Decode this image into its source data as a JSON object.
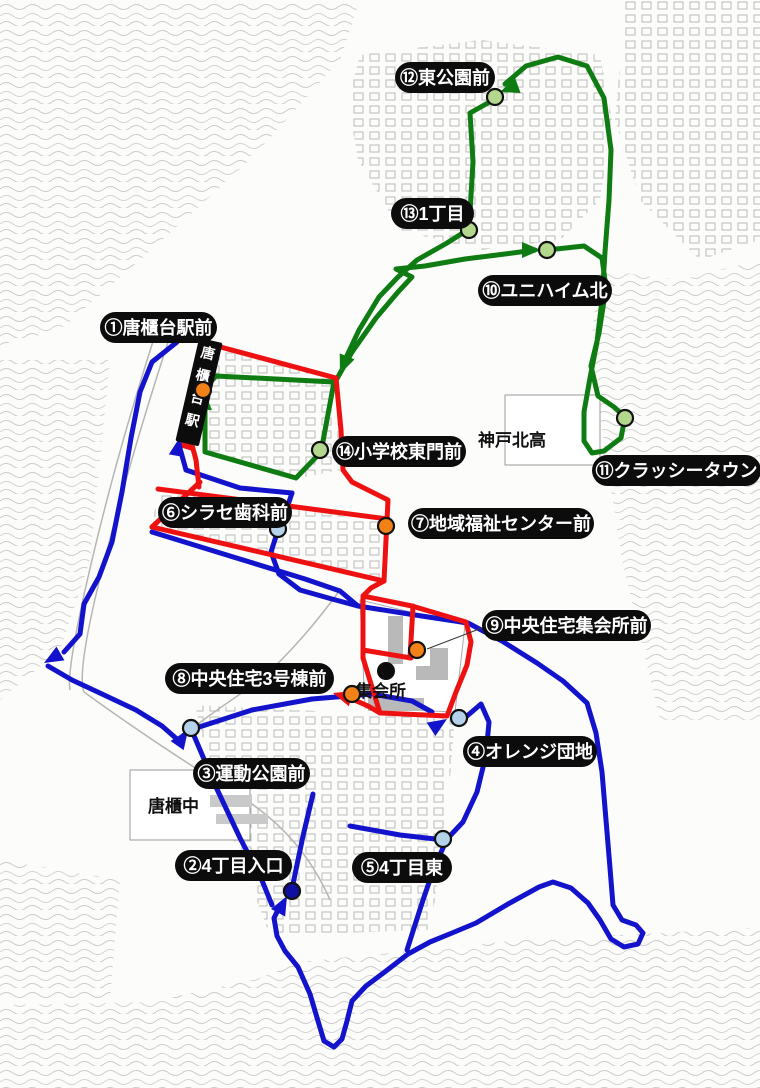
{
  "title": "community bus route map",
  "routes": {
    "colors": {
      "green": "#0e7c12",
      "red": "#ee1111",
      "blue": "#1313cc"
    },
    "paths": {
      "blue": [
        [
          [
            186,
            470
          ],
          [
            181,
            452
          ]
        ],
        [
          [
            177,
            342
          ],
          [
            152,
            362
          ],
          [
            140,
            392
          ],
          [
            131,
            438
          ],
          [
            122,
            492
          ],
          [
            112,
            542
          ],
          [
            99,
            577
          ],
          [
            84,
            604
          ],
          [
            80,
            634
          ],
          [
            64,
            652
          ]
        ],
        [
          [
            48,
            666
          ],
          [
            72,
            680
          ],
          [
            102,
            694
          ],
          [
            136,
            710
          ],
          [
            162,
            726
          ],
          [
            178,
            740
          ],
          [
            184,
            735
          ]
        ],
        [
          [
            186,
            470
          ],
          [
            240,
            488
          ],
          [
            292,
            493
          ]
        ],
        [
          [
            292,
            493
          ],
          [
            283,
            520
          ],
          [
            278,
            530
          ],
          [
            271,
            552
          ],
          [
            279,
            574
          ],
          [
            300,
            590
          ],
          [
            332,
            599
          ],
          [
            358,
            606
          ]
        ],
        [
          [
            152,
            532
          ],
          [
            230,
            556
          ],
          [
            305,
            579
          ],
          [
            340,
            591
          ],
          [
            358,
            606
          ]
        ],
        [
          [
            358,
            606
          ],
          [
            415,
            615
          ],
          [
            468,
            623
          ],
          [
            502,
            641
          ],
          [
            537,
            663
          ],
          [
            563,
            681
          ],
          [
            587,
            703
          ],
          [
            596,
            733
          ],
          [
            602,
            772
          ],
          [
            606,
            820
          ],
          [
            610,
            868
          ],
          [
            613,
            905
          ],
          [
            622,
            920
          ],
          [
            636,
            925
          ],
          [
            643,
            933
          ],
          [
            638,
            944
          ],
          [
            624,
            947
          ],
          [
            611,
            939
          ],
          [
            600,
            920
          ],
          [
            588,
            903
          ],
          [
            571,
            888
          ],
          [
            553,
            882
          ],
          [
            539,
            887
          ],
          [
            508,
            904
          ],
          [
            476,
            923
          ],
          [
            452,
            933
          ],
          [
            430,
            942
          ],
          [
            408,
            954
          ],
          [
            386,
            971
          ],
          [
            366,
            986
          ],
          [
            352,
            1001
          ],
          [
            347,
            1021
          ],
          [
            342,
            1039
          ],
          [
            334,
            1047
          ],
          [
            324,
            1041
          ],
          [
            318,
            1021
          ],
          [
            310,
            994
          ],
          [
            298,
            967
          ],
          [
            285,
            951
          ],
          [
            277,
            936
          ],
          [
            274,
            918
          ],
          [
            280,
            906
          ]
        ],
        [
          [
            193,
            729
          ],
          [
            252,
            710
          ],
          [
            312,
            699
          ],
          [
            372,
            694
          ],
          [
            412,
            701
          ],
          [
            432,
            712
          ]
        ],
        [
          [
            192,
            731
          ],
          [
            215,
            785
          ],
          [
            240,
            838
          ],
          [
            261,
            878
          ],
          [
            272,
            905
          ]
        ],
        [
          [
            460,
            722
          ],
          [
            481,
            704
          ],
          [
            489,
            722
          ],
          [
            486,
            755
          ],
          [
            477,
            792
          ],
          [
            463,
            822
          ],
          [
            447,
            839
          ],
          [
            434,
            868
          ],
          [
            423,
            900
          ],
          [
            414,
            928
          ],
          [
            407,
            950
          ]
        ],
        [
          [
            350,
            826
          ],
          [
            400,
            835
          ],
          [
            444,
            840
          ]
        ],
        [
          [
            293,
            884
          ],
          [
            303,
            836
          ],
          [
            313,
            794
          ]
        ]
      ],
      "green": [
        [
          [
            205,
            405
          ],
          [
            205,
            396
          ]
        ],
        [
          [
            205,
            395
          ],
          [
            205,
            452
          ],
          [
            296,
            478
          ],
          [
            321,
            452
          ],
          [
            334,
            382
          ],
          [
            216,
            376
          ],
          [
            206,
            387
          ],
          [
            205,
            395
          ]
        ],
        [
          [
            334,
            384
          ],
          [
            352,
            352
          ],
          [
            376,
            318
          ],
          [
            398,
            292
          ],
          [
            412,
            277
          ],
          [
            396,
            269
          ],
          [
            425,
            266
          ],
          [
            465,
            259
          ],
          [
            505,
            254
          ],
          [
            535,
            250
          ]
        ],
        [
          [
            547,
            250
          ],
          [
            584,
            246
          ],
          [
            602,
            258
          ],
          [
            606,
            288
          ],
          [
            599,
            333
          ],
          [
            591,
            366
          ],
          [
            598,
            396
          ],
          [
            614,
            407
          ],
          [
            625,
            417
          ],
          [
            621,
            438
          ],
          [
            604,
            451
          ],
          [
            592,
            453
          ],
          [
            584,
            441
          ],
          [
            584,
            412
          ],
          [
            590,
            378
          ],
          [
            597,
            342
          ],
          [
            602,
            300
          ],
          [
            605,
            252
          ],
          [
            609,
            200
          ],
          [
            611,
            150
          ],
          [
            604,
            98
          ],
          [
            587,
            66
          ],
          [
            558,
            57
          ],
          [
            526,
            66
          ],
          [
            505,
            84
          ]
        ],
        [
          [
            495,
            99
          ],
          [
            470,
            113
          ],
          [
            473,
            162
          ],
          [
            469,
            229
          ],
          [
            447,
            243
          ],
          [
            417,
            260
          ],
          [
            398,
            277
          ],
          [
            379,
            297
          ],
          [
            359,
            330
          ],
          [
            344,
            362
          ]
        ]
      ],
      "red": [
        [
          [
            199,
            487
          ],
          [
            196,
            460
          ],
          [
            192,
            445
          ]
        ],
        [
          [
            213,
            345
          ],
          [
            203,
            382
          ],
          [
            196,
            418
          ]
        ],
        [
          [
            213,
            345
          ],
          [
            336,
            378
          ],
          [
            341,
            430
          ],
          [
            343,
            470
          ],
          [
            352,
            482
          ],
          [
            388,
            500
          ],
          [
            386,
            540
          ],
          [
            384,
            581
          ]
        ],
        [
          [
            158,
            489
          ],
          [
            388,
            519
          ]
        ],
        [
          [
            200,
            482
          ],
          [
            152,
            527
          ]
        ],
        [
          [
            152,
            527
          ],
          [
            384,
            581
          ]
        ],
        [
          [
            384,
            581
          ],
          [
            371,
            588
          ],
          [
            363,
            596
          ],
          [
            363,
            658
          ]
        ],
        [
          [
            363,
            596
          ],
          [
            412,
            606
          ],
          [
            466,
            622
          ],
          [
            471,
            642
          ],
          [
            467,
            665
          ],
          [
            456,
            692
          ],
          [
            447,
            716
          ],
          [
            380,
            713
          ],
          [
            363,
            658
          ]
        ],
        [
          [
            363,
            650
          ],
          [
            411,
            658
          ]
        ],
        [
          [
            413,
            606
          ],
          [
            410,
            658
          ]
        ],
        [
          [
            380,
            713
          ],
          [
            368,
            706
          ],
          [
            352,
            699
          ],
          [
            340,
            695
          ]
        ]
      ]
    }
  },
  "arrows": [
    {
      "c": "green",
      "x": 204,
      "y": 391,
      "a": -90
    },
    {
      "c": "green",
      "x": 340,
      "y": 374,
      "a": 112
    },
    {
      "c": "green",
      "x": 541,
      "y": 250,
      "a": 0
    },
    {
      "c": "green",
      "x": 500,
      "y": 92,
      "a": 160
    },
    {
      "c": "red",
      "x": 189,
      "y": 430,
      "a": -73
    },
    {
      "c": "red",
      "x": 333,
      "y": 693,
      "a": 197
    },
    {
      "c": "blue",
      "x": 180,
      "y": 437,
      "a": -80
    },
    {
      "c": "blue",
      "x": 44,
      "y": 663,
      "a": 150
    },
    {
      "c": "blue",
      "x": 188,
      "y": 730,
      "a": -55
    },
    {
      "c": "blue",
      "x": 447,
      "y": 719,
      "a": -33
    },
    {
      "c": "blue",
      "x": 287,
      "y": 896,
      "a": -62
    }
  ],
  "marker_colors": {
    "orange": "#f28118",
    "lightgreen": "#b2d78d",
    "lightblue": "#b4d2ea",
    "darkblue": "#0f0fa0"
  },
  "stops": [
    {
      "label": "①唐櫃台駅前",
      "marker": "orange",
      "mx": 203,
      "my": 390,
      "lx": 100,
      "ly": 312
    },
    {
      "label": "②4丁目入口",
      "marker": "darkblue",
      "mx": 292,
      "my": 891,
      "lx": 175,
      "ly": 850
    },
    {
      "label": "③運動公園前",
      "marker": "lightblue",
      "mx": 191,
      "my": 728,
      "lx": 193,
      "ly": 758
    },
    {
      "label": "④オレンジ団地",
      "marker": "lightblue",
      "mx": 459,
      "my": 718,
      "lx": 463,
      "ly": 736
    },
    {
      "label": "⑤4丁目東",
      "marker": "lightblue",
      "mx": 443,
      "my": 839,
      "lx": 352,
      "ly": 852
    },
    {
      "label": "⑥シラセ歯科前",
      "marker": "lightblue",
      "mx": 278,
      "my": 529,
      "lx": 158,
      "ly": 497
    },
    {
      "label": "⑦地域福祉センター前",
      "marker": "orange",
      "mx": 386,
      "my": 526,
      "lx": 408,
      "ly": 508
    },
    {
      "label": "⑧中央住宅3号棟前",
      "marker": "orange",
      "mx": 352,
      "my": 694,
      "lx": 165,
      "ly": 663
    },
    {
      "label": "⑨中央住宅集会所前",
      "marker": "orange",
      "mx": 417,
      "my": 650,
      "lx": 482,
      "ly": 610
    },
    {
      "label": "⑩ユニハイム北",
      "marker": "lightgreen",
      "mx": 547,
      "my": 250,
      "lx": 478,
      "ly": 275
    },
    {
      "label": "⑪クラッシータウン",
      "marker": "lightgreen",
      "mx": 625,
      "my": 418,
      "lx": 592,
      "ly": 455
    },
    {
      "label": "⑫東公園前",
      "marker": "lightgreen",
      "mx": 495,
      "my": 97,
      "lx": 395,
      "ly": 62
    },
    {
      "label": "⑬1丁目",
      "marker": "lightgreen",
      "mx": 469,
      "my": 230,
      "lx": 391,
      "ly": 198
    },
    {
      "label": "⑭小学校東門前",
      "marker": "lightgreen",
      "mx": 320,
      "my": 450,
      "lx": 332,
      "ly": 436
    }
  ],
  "connector_line": [
    [
      427,
      649
    ],
    [
      487,
      626
    ]
  ],
  "places": {
    "high_school": {
      "text": "神戸北高",
      "x": 478,
      "y": 446
    },
    "junior_high": {
      "text": "唐櫃中",
      "x": 148,
      "y": 812
    },
    "meeting_hall": {
      "text": "集会所",
      "x": 355,
      "y": 697,
      "dot": [
        386,
        671
      ]
    }
  },
  "station_sign": {
    "text": "唐櫃台駅"
  }
}
